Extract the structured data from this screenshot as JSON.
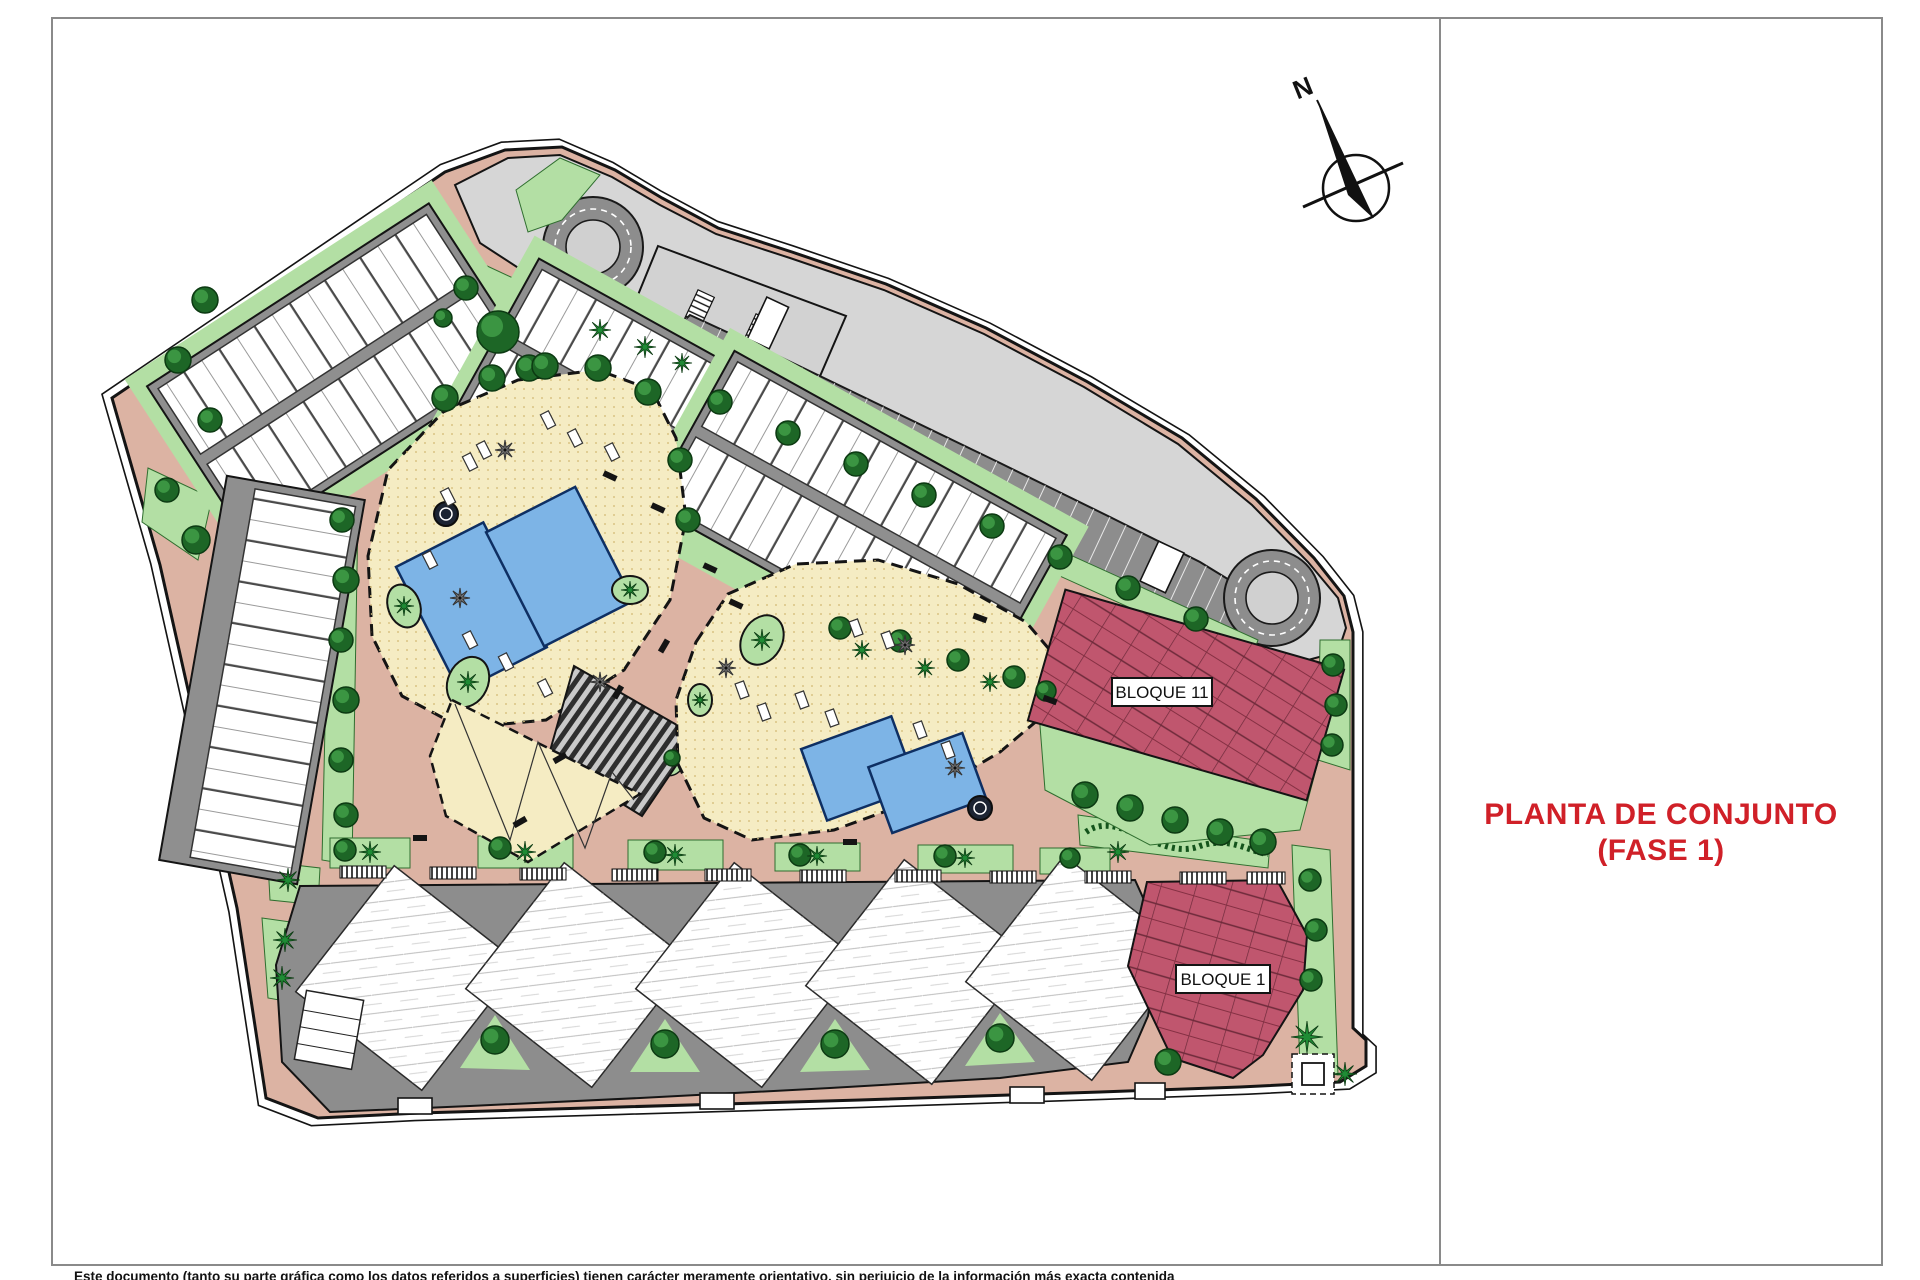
{
  "titleblock": {
    "title_line1": "PLANTA DE CONJUNTO",
    "title_line2": "(FASE 1)",
    "title_color": "#d02028"
  },
  "plan": {
    "north_label": "N",
    "block_labels": [
      {
        "id": "bloque11",
        "text": "BLOQUE 11"
      },
      {
        "id": "bloque1",
        "text": "BLOQUE 1"
      }
    ],
    "disclaimer": "Este documento (tanto su parte gráfica como los datos referidos a superficies) tienen carácter meramente orientativo, sin perjuicio de la información más exacta contenida",
    "colors": {
      "road_salmon": "#dcb3a3",
      "road_light_gray": "#d6d6d6",
      "parking_gray": "#8d8d8d",
      "lawn_green": "#b3dfa4",
      "tree_green": "#1d6626",
      "palm_green": "#1f8c35",
      "amenity_cream": "#f5ecc3",
      "pool_blue": "#7db4e6",
      "building_white": "#ffffff",
      "bloque_maroon": "#c0566e",
      "title_red": "#d02028",
      "line_black": "#141414"
    }
  }
}
